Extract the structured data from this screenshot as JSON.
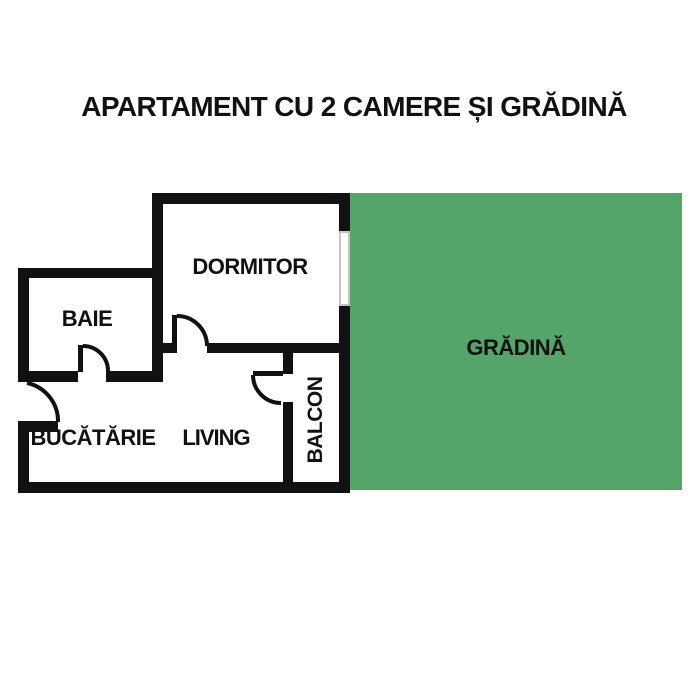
{
  "title": "APARTAMENT CU 2 CAMERE ȘI GRĂDINĂ",
  "floor_plan": {
    "rooms": [
      {
        "id": "dormitor",
        "label": "DORMITOR"
      },
      {
        "id": "baie",
        "label": "BAIE"
      },
      {
        "id": "bucatarie",
        "label": "BUCĂTĂRIE"
      },
      {
        "id": "living",
        "label": "LIVING"
      },
      {
        "id": "balcon",
        "label": "BALCON"
      },
      {
        "id": "gradina",
        "label": "GRĂDINĂ"
      }
    ],
    "features": [
      "window-dormitor-to-garden",
      "door-dormitor-living",
      "door-baie-bucatarie",
      "door-living-balcon",
      "door-entry-exterior"
    ]
  },
  "colors": {
    "wall": "#111111",
    "garden_fill": "#55a469",
    "window_frame": "#c4c4c4",
    "background": "#ffffff",
    "text": "#111111"
  }
}
